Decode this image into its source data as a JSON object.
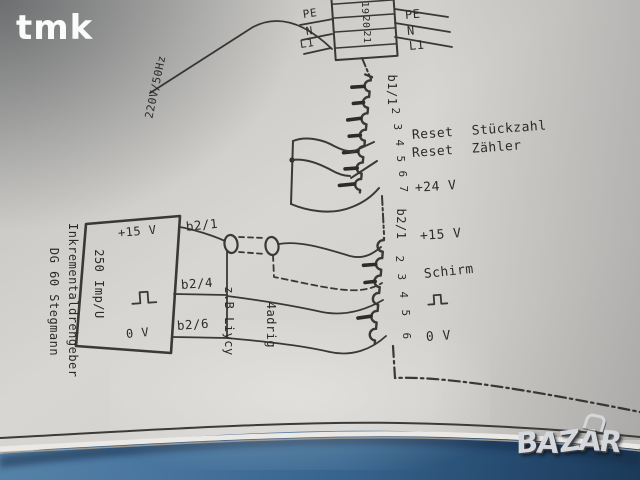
{
  "colors": {
    "table_blue": "#36638d",
    "table_dark": "#1b3a59",
    "paper": "#d6d4d0",
    "ink": "#2b2b29",
    "logo_silver": "#d4d7db",
    "watermark_white": "#ffffff"
  },
  "watermark": {
    "text": "tmk"
  },
  "schematic": {
    "supply_label": "220V/50Hz",
    "terminal_block": {
      "cell_numbers": [
        "18",
        "19",
        "20",
        "21"
      ],
      "left_labels": [
        "PE",
        "N",
        "L1"
      ],
      "right_labels": [
        "PE",
        "N",
        "L1"
      ]
    },
    "strip_b1": {
      "header": "b1/1",
      "pin_numbers": [
        "2",
        "3",
        "4",
        "5",
        "6",
        "7"
      ],
      "label_reset_stueckzahl": "Reset Stückzahl",
      "label_reset_zaehler": "Reset Zähler",
      "label_24v": "+24 V"
    },
    "strip_b2": {
      "header": "b2/1",
      "pin_numbers": [
        "2",
        "3",
        "4",
        "5",
        "6"
      ],
      "label_15v": "+15 V",
      "label_schirm": "Schirm",
      "label_0v": "0 V"
    },
    "encoder": {
      "name_line1": "Inkrementaldrehgeber",
      "name_line2": "DG 60 Stegmann",
      "label_15v": "+15 V",
      "label_resolution": "250 Imp/U",
      "label_0v": "0 V"
    },
    "wire_labels": {
      "w1": "b2/1",
      "w2": "b2/4",
      "w3": "b2/6"
    },
    "cable": {
      "type_label": "z.B Liycy",
      "cores_label": "4adrig"
    }
  },
  "logo": {
    "letters": [
      "B",
      "A",
      "Z",
      "A",
      "R"
    ]
  }
}
